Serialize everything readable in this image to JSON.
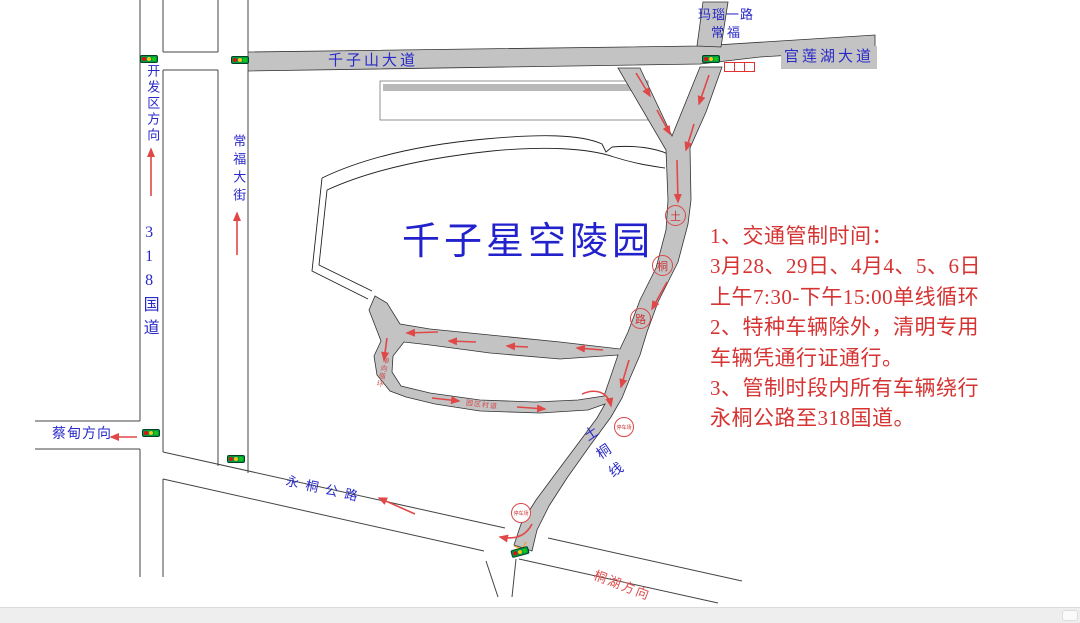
{
  "map": {
    "cemetery_label": "千子星空陵园",
    "roads": {
      "qianzishan_avenue": "千子山大道",
      "guanlianhu_avenue": "官莲湖大道",
      "manao_road": "玛瑙一路",
      "changfu": "常福",
      "kaifaqu_direction": "开发区方向",
      "g318": "318国道",
      "changfu_street": "常福大街",
      "caidian_direction": "蔡甸方向",
      "yongtong_highway": "永桐公路",
      "tonghu_direction": "桐湖方向",
      "tutong_line": "土桐线"
    },
    "road_markers": [
      "土",
      "桐",
      "路"
    ],
    "checkpoints": [
      "停车场",
      "停车场"
    ],
    "loop_side_label": "单向循环",
    "loop_bottom_label": "园区村道"
  },
  "notice": {
    "lines": [
      "1、交通管制时间：",
      "3月28、29日、4月4、5、6日",
      "上午7:30-下午15:00单线循环",
      "2、特种车辆除外，清明专用",
      "车辆凭通行证通行。",
      "3、管制时段内所有车辆绕行",
      "永桐公路至318国道。"
    ]
  },
  "colors": {
    "road_gray": "#c3c3c3",
    "label_blue": "#2a2ac8",
    "notice_red": "#d63333",
    "arrow_red": "#e04848"
  }
}
